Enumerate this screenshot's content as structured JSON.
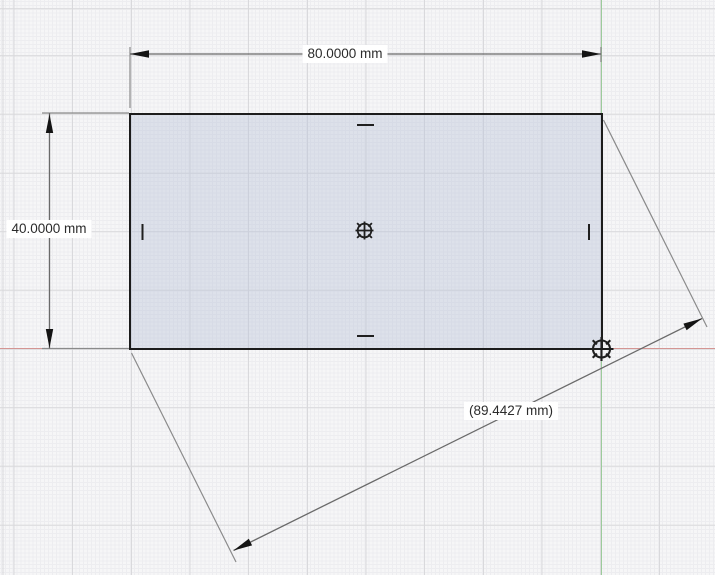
{
  "canvas": {
    "type": "cad-sketch-grid",
    "units": "mm"
  },
  "dimension_labels": {
    "width": "80.0000 mm",
    "height": "40.0000 mm",
    "diagonal": "(89.4427 mm)"
  },
  "sketch": {
    "shape": "rectangle",
    "width_mm": 80.0,
    "height_mm": 40.0,
    "diagonal_mm": 89.4427,
    "markers": [
      "center-point",
      "origin-point"
    ],
    "constraints": [
      "midpoint-top",
      "midpoint-bottom",
      "midpoint-left",
      "midpoint-right"
    ]
  },
  "colors": {
    "background": "#f6f6f7",
    "grid_major": "#d9d9dc",
    "grid_minor": "#ededf0",
    "x_axis": "#d49593",
    "y_axis": "#9ccb9b",
    "sketch_edge": "#1c1c1c",
    "sketch_fill": "#e2e5ed",
    "dimension_line": "#6a6a6a",
    "extension_line": "#8a8a8a",
    "arrow": "#141414",
    "marker": "#1f1f1f"
  }
}
